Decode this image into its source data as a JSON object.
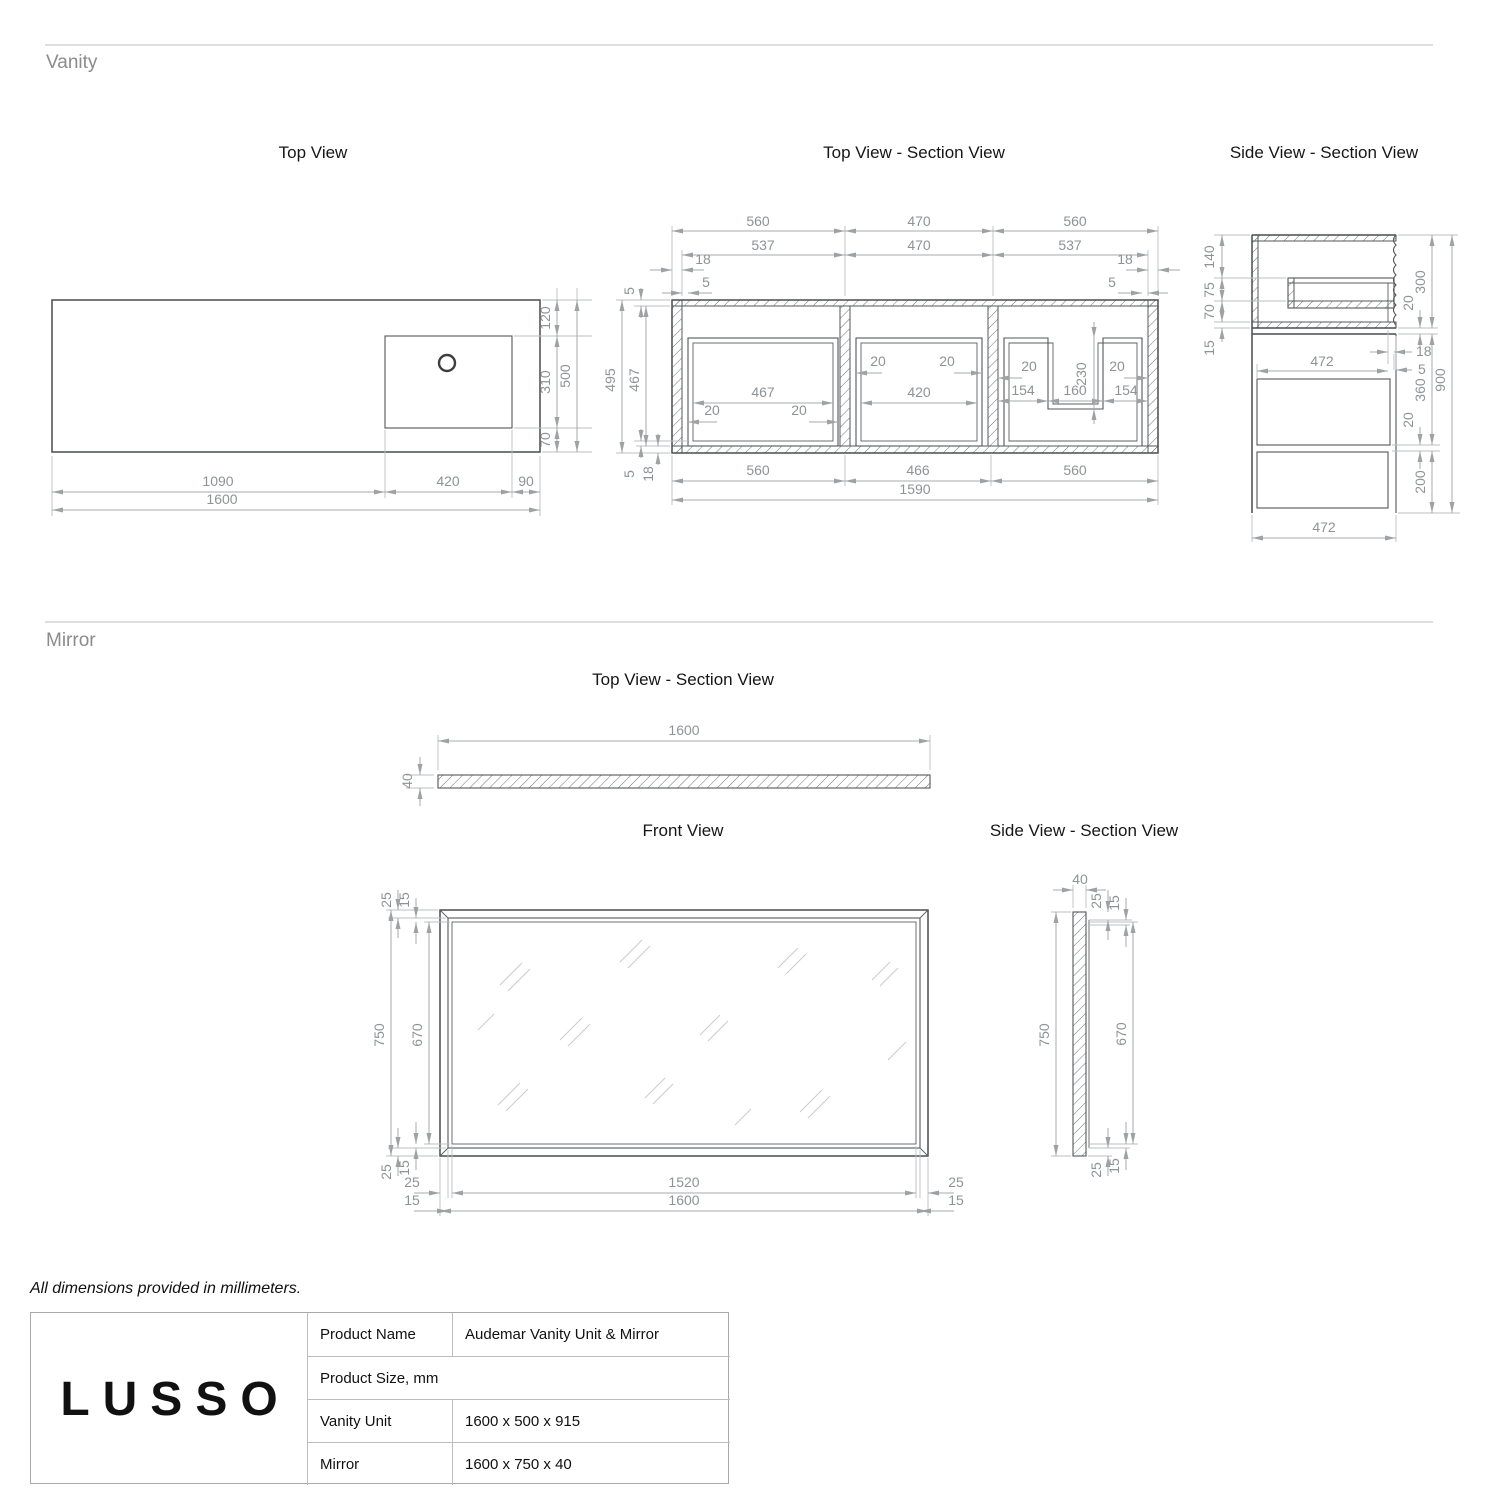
{
  "note": "All dimensions provided in millimeters.",
  "colors": {
    "drawing_line": "#494c4e",
    "dimension_line": "#a6aaac",
    "dimension_text": "#8e9396",
    "title_text": "#161616"
  },
  "vanity": {
    "label": "Vanity",
    "top_view": {
      "title": "Top View",
      "d120": "120",
      "d310": "310",
      "d70": "70",
      "d500": "500",
      "d1090": "1090",
      "d420": "420",
      "d90": "90",
      "d1600": "1600"
    },
    "section_view": {
      "title": "Top View - Section View",
      "t560l": "560",
      "t470a": "470",
      "t560r": "560",
      "t537l": "537",
      "t470b": "470",
      "t537r": "537",
      "t18l": "18",
      "t5l": "5",
      "t18r": "18",
      "t5r": "5",
      "t5top": "5",
      "l495": "495",
      "l467": "467",
      "bl5": "5",
      "bl18": "18",
      "c1_467": "467",
      "c1_20l": "20",
      "c1_20r": "20",
      "c2_20l": "20",
      "c2_20r": "20",
      "c2_420": "420",
      "c3_20l": "20",
      "c3_20r": "20",
      "c3_154l": "154",
      "c3_160": "160",
      "c3_154r": "154",
      "c3_230": "230",
      "b560l": "560",
      "b466": "466",
      "b560r": "560",
      "b1590": "1590"
    },
    "side_view": {
      "title": "Side View - Section View",
      "l140": "140",
      "l75": "75",
      "l70": "70",
      "l15": "15",
      "r300": "300",
      "r20top": "20",
      "r18": "18",
      "r5": "5",
      "m472": "472",
      "r360": "360",
      "r20bot": "20",
      "r200": "200",
      "r900": "900",
      "b472": "472"
    }
  },
  "mirror": {
    "label": "Mirror",
    "top_view": {
      "title": "Top View - Section View",
      "w1600": "1600",
      "t40": "40"
    },
    "front_view": {
      "title": "Front View",
      "tl25": "25",
      "tl15": "15",
      "l750": "750",
      "l670": "670",
      "bl25": "25",
      "bl15": "15",
      "bh25l": "25",
      "bh15l": "15",
      "b1520": "1520",
      "b1600": "1600",
      "bh25r": "25",
      "bh15r": "15"
    },
    "side_view": {
      "title": "Side View - Section View",
      "t40": "40",
      "tr25": "25",
      "tr15": "15",
      "l750": "750",
      "r670": "670",
      "br25": "25",
      "br15": "15"
    }
  },
  "title_block": {
    "brand": "LUSSO",
    "product_name_label": "Product Name",
    "product_name": "Audemar Vanity Unit & Mirror",
    "size_label": "Product Size, mm",
    "vanity_label": "Vanity Unit",
    "vanity_size": "1600 x 500 x 915",
    "mirror_label": "Mirror",
    "mirror_size": "1600 x 750 x 40"
  }
}
